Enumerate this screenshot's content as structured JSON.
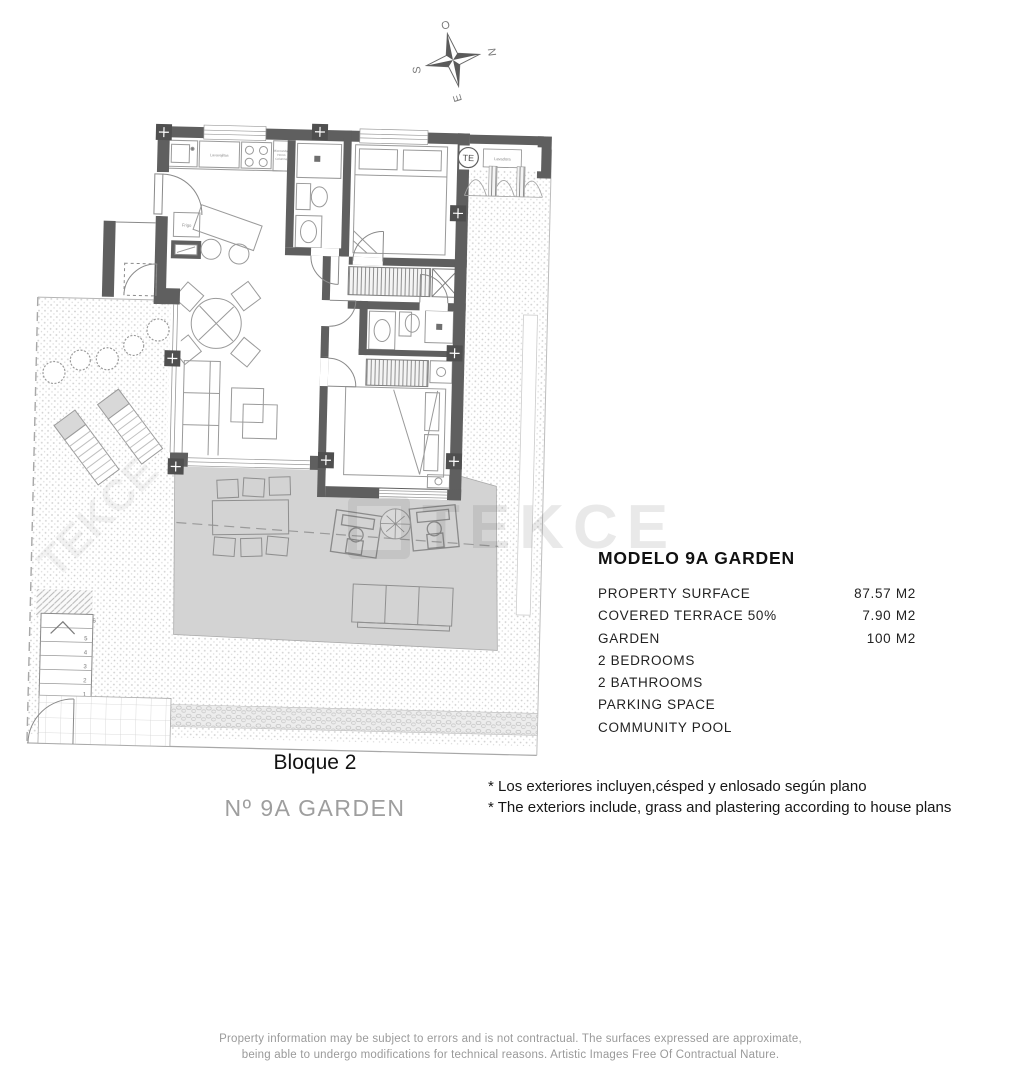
{
  "compass": {
    "top": "O",
    "right": "N",
    "bottom": "E",
    "left": "S"
  },
  "floorplan": {
    "labels": {
      "te": "TE",
      "lavadora": "Lavadora",
      "lavavajillas": "Lavavajillas",
      "micro_line1": "Microondas",
      "micro_line2": "Horno",
      "micro_line3": "Columna",
      "frigo": "Frigo"
    },
    "stair_numbers": [
      "1",
      "2",
      "3",
      "4",
      "5",
      "6"
    ]
  },
  "watermark": {
    "text": "TEKCE"
  },
  "specs": {
    "title": "MODELO 9A GARDEN",
    "rows": [
      {
        "label": "PROPERTY SURFACE",
        "value": "87.57 M2"
      },
      {
        "label": "COVERED TERRACE 50%",
        "value": "7.90 M2"
      },
      {
        "label": "GARDEN",
        "value": "100 M2"
      },
      {
        "label": "2 BEDROOMS",
        "value": ""
      },
      {
        "label": "2 BATHROOMS",
        "value": ""
      },
      {
        "label": "PARKING SPACE",
        "value": ""
      },
      {
        "label": "COMMUNITY POOL",
        "value": ""
      }
    ]
  },
  "block_label": "Bloque 2",
  "unit_label": "Nº 9A GARDEN",
  "notes": {
    "line1": "* Los exteriores incluyen,césped y enlosado según plano",
    "line2": "* The exteriors include, grass and plastering according to house plans"
  },
  "footer": {
    "line1": "Property information may be subject to errors and is not contractual. The surfaces expressed are approximate,",
    "line2": "being able to undergo modifications for technical reasons. Artistic Images Free Of Contractual Nature."
  },
  "colors": {
    "wall": "#5f5f5f",
    "terrace_fill": "#d3d3d3",
    "muted_text": "#9e9e9e"
  }
}
